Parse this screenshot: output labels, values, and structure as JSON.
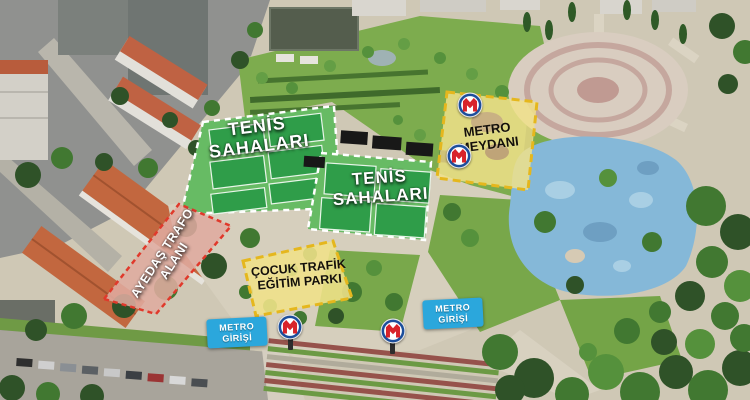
{
  "areas": {
    "tennis_left": {
      "line1": "TENİS",
      "line2": "SAHALARI"
    },
    "tennis_center": {
      "line1": "TENİS",
      "line2": "SAHALARI"
    },
    "metro_square": {
      "line1": "METRO",
      "line2": "MEYDANI"
    },
    "trafo": {
      "line1": "AYEDAŞ TRAFO",
      "line2": "ALANI"
    },
    "traffic_park": {
      "line1": "ÇOCUK TRAFİK",
      "line2": "EĞİTİM PARKI"
    },
    "metro_entrance_left": {
      "line1": "METRO",
      "line2": "GİRİŞİ"
    },
    "metro_entrance_right": {
      "line1": "METRO",
      "line2": "GİRİŞİ"
    }
  },
  "icons": {
    "metro_logo": "istanbul-metro-m-logo"
  },
  "colors": {
    "highlight_yellow": "#f0e189",
    "highlight_yellow_border": "#e5b71d",
    "highlight_pink": "#dfab9f",
    "highlight_pink_border": "#e0392b",
    "entrance_badge_blue": "#2ba7dc",
    "tennis_area_green": "#67bb64",
    "tennis_court_green": "#2f9d49",
    "court_dash_white": "#ffffff",
    "metro_logo_red": "#d8232a",
    "metro_logo_blue": "#1c4e9c"
  }
}
